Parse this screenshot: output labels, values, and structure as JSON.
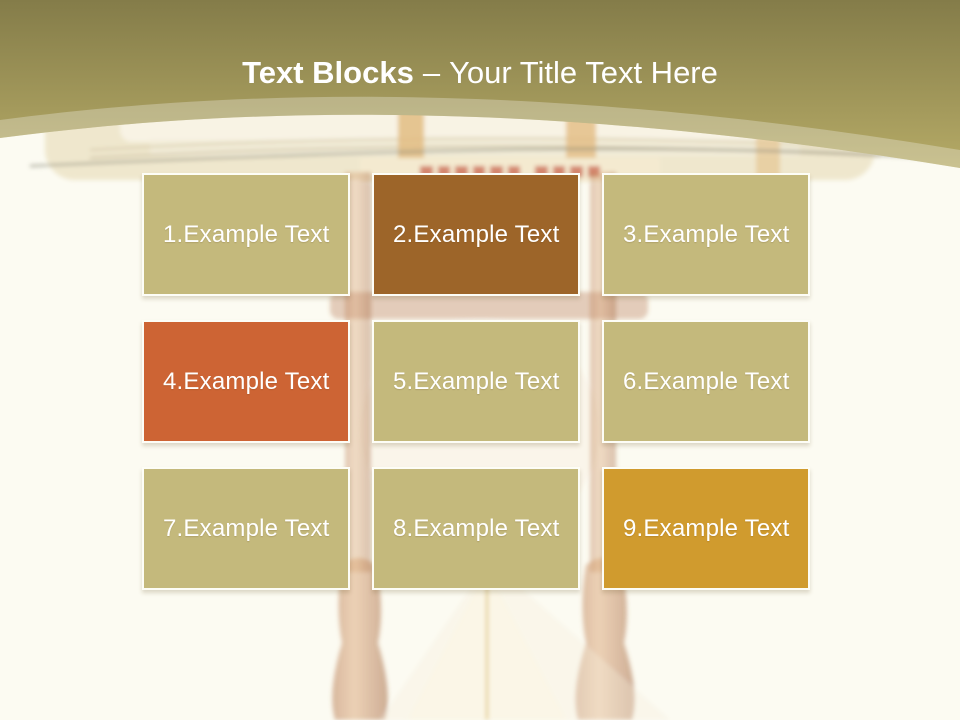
{
  "slide": {
    "title": {
      "emphasis": "Text Blocks",
      "separator": "–",
      "subtitle": "Your Title Text Here"
    },
    "palette": {
      "khaki": "#c4b97c",
      "brown": "#9d6529",
      "orange": "#cd6434",
      "gold": "#d09b2e",
      "header_top": "#847c49",
      "header_bottom": "#b5aa66",
      "background": "#fcfbf2",
      "text": "#ffffff"
    },
    "blocks": [
      {
        "label": "1.Example Text",
        "color": "khaki"
      },
      {
        "label": "2.Example Text",
        "color": "brown"
      },
      {
        "label": "3.Example Text",
        "color": "khaki"
      },
      {
        "label": "4.Example Text",
        "color": "orange"
      },
      {
        "label": "5.Example Text",
        "color": "khaki"
      },
      {
        "label": "6.Example Text",
        "color": "khaki"
      },
      {
        "label": "7.Example Text",
        "color": "khaki"
      },
      {
        "label": "8.Example Text",
        "color": "khaki"
      },
      {
        "label": "9.Example Text",
        "color": "gold"
      }
    ]
  }
}
